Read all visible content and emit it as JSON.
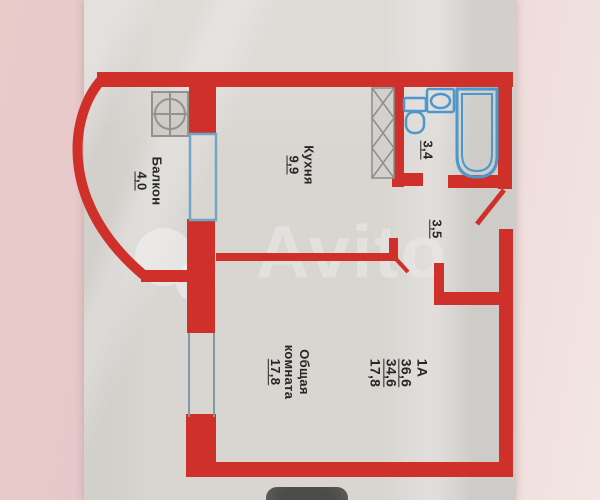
{
  "image_type": "apartment floor plan photo",
  "watermark": "Avito",
  "rooms": {
    "balcony": {
      "name": "Балкон",
      "area": "4,0"
    },
    "kitchen": {
      "name": "Кухня",
      "area": "9,9"
    },
    "bathroom": {
      "area": "3,4"
    },
    "hallway": {
      "area": "3,5"
    },
    "living_room": {
      "name_line1": "Общая",
      "name_line2": "комната",
      "area": "17,8"
    }
  },
  "apartment_spec": {
    "type": "1А",
    "total_area": "36,6",
    "living_area": "34,6",
    "room_area": "17,8"
  },
  "icons": {
    "stove": "stove-burner-icon",
    "vent_shaft": "vent-shaft-icon",
    "toilet": "toilet-icon",
    "sink": "sink-icon",
    "bathtub": "bathtub-icon",
    "balcony_door": "balcony-door-window",
    "window": "window-double-line",
    "entrance_door": "door-swing-line"
  },
  "colors": {
    "wall_red": "#d0302a",
    "fixture_blue": "#4e97cc",
    "paper": "#d9d6d2",
    "background_pink": "#e9cbca",
    "badge_gray": "#4b4b49"
  }
}
